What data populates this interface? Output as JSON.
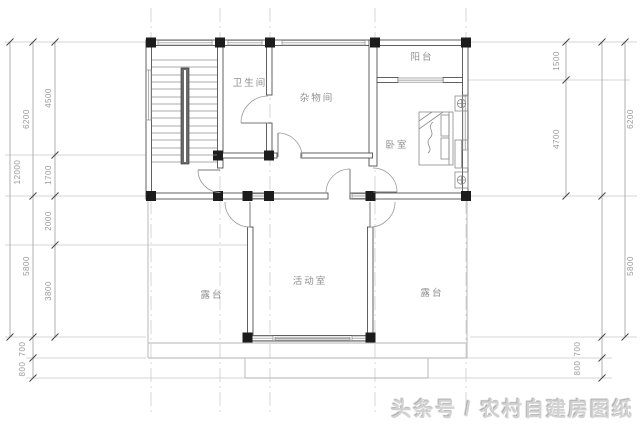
{
  "drawing": {
    "type": "architectural-floor-plan",
    "floor": "upper-storey"
  },
  "rooms": {
    "bathroom": "卫生间",
    "storage": "杂物间",
    "balcony": "阳台",
    "bedroom": "卧室",
    "activity": "活动室",
    "terrace_left": "露台",
    "terrace_right": "露台"
  },
  "dimensions": {
    "left_inner": [
      "4500",
      "1700",
      "2000",
      "3800"
    ],
    "left_mid": [
      "6200",
      "5800"
    ],
    "left_outer": [
      "12000"
    ],
    "left_steps": [
      "700",
      "800"
    ],
    "right_inner": [
      "1500",
      "4700"
    ],
    "right_outer": [
      "6200",
      "5800"
    ],
    "right_steps": [
      "700",
      "800"
    ]
  },
  "watermark": {
    "text": "头条号 / 农村自建房图纸"
  },
  "colors": {
    "background": "#ffffff",
    "wall_line": "#4f4f4f",
    "column_fill": "#1c1c1c",
    "grid_line": "#c6c6c6",
    "dimension_line": "#9e9e9e",
    "dimension_text": "#9a9a9a",
    "room_label": "#8f8f8f",
    "watermark_text": "#d2d2d2"
  }
}
